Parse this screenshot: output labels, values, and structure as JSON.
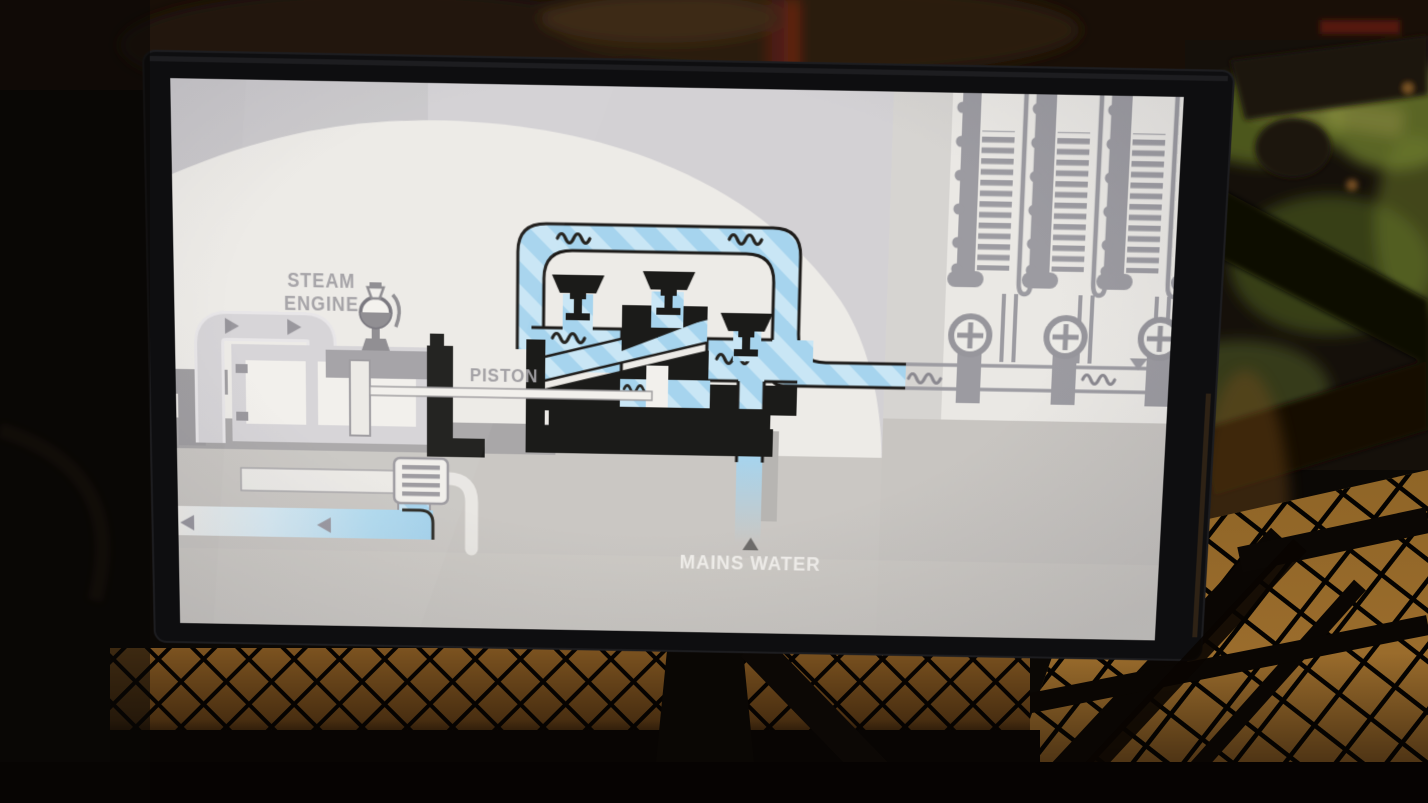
{
  "screen": {
    "labels": {
      "steam_engine_line1": "STEAM",
      "steam_engine_line2": "ENGINE",
      "piston": "PISTON",
      "mains_water": "MAINS WATER"
    },
    "illustrations": [
      "steam-engine-icon",
      "governor-icon",
      "piston-rod-icon",
      "steam-pipe-loop-icon",
      "condenser-icon",
      "return-pipe-icon",
      "water-pump-icon",
      "pump-valve-icon",
      "water-loop-icon",
      "mains-water-inlet-icon",
      "cooling-column-icon",
      "handwheel-valve-icon",
      "water-main-icon",
      "flow-arrow-icon",
      "water-wave-icon"
    ],
    "colors": {
      "water_blue": "#a6d4ee",
      "water_stripe": "#cfe9f7",
      "diagram_ink": "#1c1a18",
      "pipe_gray": "#9c9ba1",
      "engine_light_gray": "#d7d5d8",
      "label_gray": "#a3a1a5",
      "label_white": "#f2f0ec",
      "dome_white": "#edebe7",
      "screen_gray": "#d0cecf",
      "band_dark_gray": "#a9a7a8",
      "band_beige": "#cac7c3",
      "bezel_black": "#0e0e10",
      "floor_amber": "#8f6527",
      "machinery_green": "#5c6a26"
    }
  }
}
